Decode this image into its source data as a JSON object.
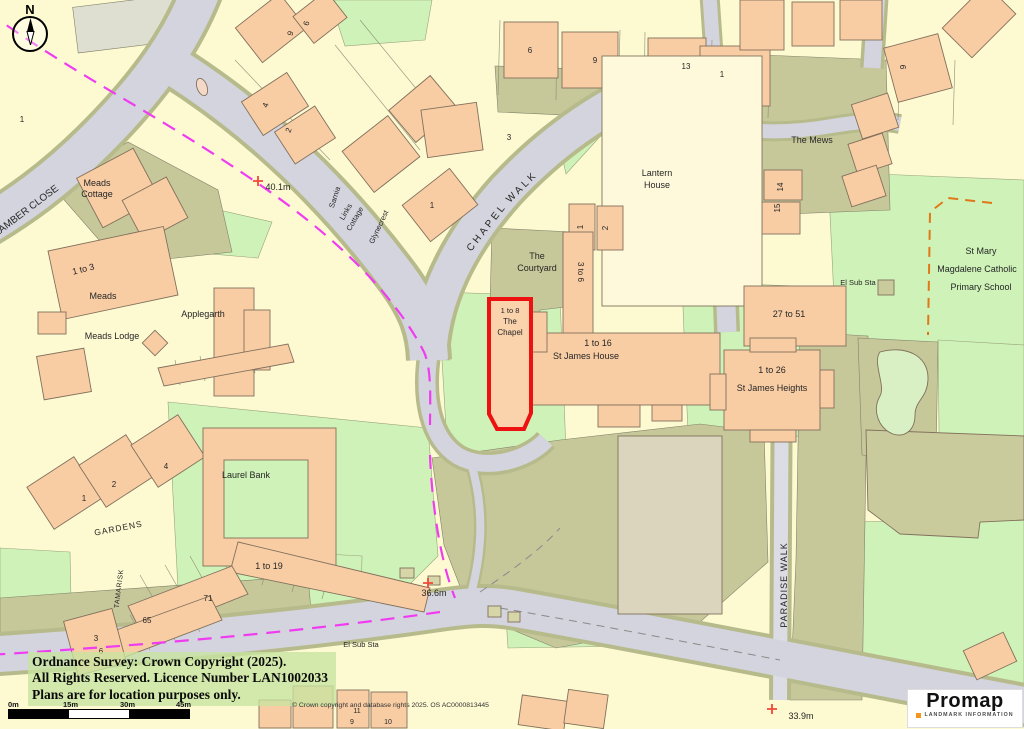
{
  "colors": {
    "parcel_yellow": "#FDFAD2",
    "building_peach": "#F8CDA4",
    "building_cream": "#FDF9DA",
    "road_gray": "#D4D4DE",
    "verge_olive": "#B7BB8B",
    "garden_olive": "#C6C89A",
    "grass_green": "#CEF2B8",
    "site_boundary_red": "#EE1111",
    "route_magenta": "#F03CF0",
    "route_orange": "#E07818",
    "spot_cross": "#F04838",
    "label_text": "#262626"
  },
  "north_indicator": {
    "letter": "N"
  },
  "labels": [
    {
      "t": "LAMBER CLOSE",
      "x": 28,
      "y": 213,
      "r": -37,
      "s": 10
    },
    {
      "t": "Meads",
      "x": 97,
      "y": 186,
      "s": 9
    },
    {
      "t": "Cottage",
      "x": 97,
      "y": 197,
      "s": 9
    },
    {
      "t": "1 to 3",
      "x": 84,
      "y": 272,
      "r": -14,
      "s": 9
    },
    {
      "t": "Meads",
      "x": 103,
      "y": 299,
      "s": 9
    },
    {
      "t": "Applegarth",
      "x": 203,
      "y": 317,
      "s": 9
    },
    {
      "t": "Meads Lodge",
      "x": 112,
      "y": 339,
      "s": 9
    },
    {
      "t": "40.1m",
      "x": 278,
      "y": 190,
      "s": 9
    },
    {
      "t": "Sarnia",
      "x": 337,
      "y": 198,
      "r": -72,
      "s": 7.5
    },
    {
      "t": "Links",
      "x": 348,
      "y": 213,
      "r": -60,
      "s": 7.5
    },
    {
      "t": "Cottage",
      "x": 357,
      "y": 220,
      "r": -60,
      "s": 7.5
    },
    {
      "t": "Glynecrest",
      "x": 381,
      "y": 228,
      "r": -65,
      "s": 7.5
    },
    {
      "t": "CHAPEL",
      "x": 489,
      "y": 229,
      "r": -52,
      "s": 10,
      "sp": 3
    },
    {
      "t": "WALK",
      "x": 524,
      "y": 189,
      "r": -45,
      "s": 10,
      "sp": 3
    },
    {
      "t": "The",
      "x": 537,
      "y": 259,
      "s": 9
    },
    {
      "t": "Courtyard",
      "x": 537,
      "y": 271,
      "s": 9
    },
    {
      "t": "1 to 8",
      "x": 510,
      "y": 313,
      "s": 7.5
    },
    {
      "t": "The",
      "x": 510,
      "y": 324,
      "s": 8
    },
    {
      "t": "Chapel",
      "x": 510,
      "y": 335,
      "s": 8
    },
    {
      "t": "Lantern",
      "x": 657,
      "y": 176,
      "s": 9
    },
    {
      "t": "House",
      "x": 657,
      "y": 188,
      "s": 9
    },
    {
      "t": "1",
      "x": 583,
      "y": 227,
      "r": -90,
      "s": 8
    },
    {
      "t": "2",
      "x": 608,
      "y": 228,
      "r": -90,
      "s": 8
    },
    {
      "t": "3 to 6",
      "x": 578,
      "y": 272,
      "r": 90,
      "s": 8
    },
    {
      "t": "1 to 16",
      "x": 598,
      "y": 346,
      "s": 9
    },
    {
      "t": "St James House",
      "x": 586,
      "y": 359,
      "s": 9
    },
    {
      "t": "The Mews",
      "x": 812,
      "y": 143,
      "s": 9
    },
    {
      "t": "14",
      "x": 783,
      "y": 187,
      "r": -90,
      "s": 8
    },
    {
      "t": "15",
      "x": 780,
      "y": 208,
      "r": -90,
      "s": 8
    },
    {
      "t": "El Sub Sta",
      "x": 858,
      "y": 285,
      "s": 7.5
    },
    {
      "t": "27 to 51",
      "x": 789,
      "y": 317,
      "s": 9
    },
    {
      "t": "1 to 26",
      "x": 772,
      "y": 373,
      "s": 9
    },
    {
      "t": "St James Heights",
      "x": 772,
      "y": 391,
      "s": 9
    },
    {
      "t": "St Mary",
      "x": 981,
      "y": 254,
      "s": 9
    },
    {
      "t": "Magdalene Catholic",
      "x": 977,
      "y": 272,
      "s": 9
    },
    {
      "t": "Primary School",
      "x": 981,
      "y": 290,
      "s": 9
    },
    {
      "t": "PARADISE WALK",
      "x": 787,
      "y": 585,
      "r": -90,
      "s": 9,
      "sp": 1
    },
    {
      "t": "36.6m",
      "x": 434,
      "y": 596,
      "s": 9
    },
    {
      "t": "El Sub Sta",
      "x": 361,
      "y": 647,
      "s": 7.5
    },
    {
      "t": "33.9m",
      "x": 801,
      "y": 719,
      "s": 9
    },
    {
      "t": "GARDENS",
      "x": 119,
      "y": 531,
      "r": -11,
      "s": 8.5,
      "sp": 1
    },
    {
      "t": "TAMARISK",
      "x": 121,
      "y": 589,
      "r": -83,
      "s": 7,
      "sp": 0.5
    },
    {
      "t": "Laurel Bank",
      "x": 246,
      "y": 478,
      "s": 9
    },
    {
      "t": "1 to 19",
      "x": 269,
      "y": 569,
      "s": 9
    },
    {
      "t": "71",
      "x": 208,
      "y": 601,
      "s": 8
    },
    {
      "t": "65",
      "x": 147,
      "y": 623,
      "s": 8
    },
    {
      "t": "3",
      "x": 96,
      "y": 641,
      "s": 8
    },
    {
      "t": "6",
      "x": 101,
      "y": 654,
      "s": 8
    },
    {
      "t": "1",
      "x": 84,
      "y": 501,
      "s": 8
    },
    {
      "t": "2",
      "x": 114,
      "y": 487,
      "s": 8
    },
    {
      "t": "4",
      "x": 166,
      "y": 469,
      "s": 8
    },
    {
      "t": "6",
      "x": 530,
      "y": 53,
      "s": 8
    },
    {
      "t": "9",
      "x": 595,
      "y": 63,
      "s": 8
    },
    {
      "t": "13",
      "x": 686,
      "y": 69,
      "s": 8
    },
    {
      "t": "1",
      "x": 722,
      "y": 77,
      "s": 8
    },
    {
      "t": "3",
      "x": 509,
      "y": 140,
      "s": 8
    },
    {
      "t": "9",
      "x": 293,
      "y": 34,
      "r": -75,
      "s": 8
    },
    {
      "t": "6",
      "x": 309,
      "y": 24,
      "r": -75,
      "s": 8
    },
    {
      "t": "4",
      "x": 268,
      "y": 106,
      "r": -70,
      "s": 8
    },
    {
      "t": "2",
      "x": 291,
      "y": 131,
      "r": -70,
      "s": 8
    },
    {
      "t": "9",
      "x": 906,
      "y": 67,
      "r": -90,
      "s": 8
    },
    {
      "t": "1",
      "x": 432,
      "y": 208,
      "s": 8
    },
    {
      "t": "1",
      "x": 22,
      "y": 122,
      "s": 8
    },
    {
      "t": "11",
      "x": 357,
      "y": 713,
      "s": 7
    },
    {
      "t": "9",
      "x": 352,
      "y": 724,
      "s": 7
    },
    {
      "t": "10",
      "x": 388,
      "y": 724,
      "s": 7
    }
  ],
  "spot_crosses": [
    {
      "x": 258,
      "y": 181
    },
    {
      "x": 428,
      "y": 583
    },
    {
      "x": 772,
      "y": 709
    }
  ],
  "attribution": {
    "line1": "Ordnance Survey: Crown Copyright (2025).",
    "line2": "All Rights Reserved. Licence Number LAN1002033",
    "line3": "Plans are for location purposes only."
  },
  "scale_bar": {
    "ticks": [
      "0m",
      "15m",
      "30m",
      "45m"
    ]
  },
  "os_credit": "© Crown copyright and database rights 2025. OS AC0000813445",
  "logo": {
    "brand": "Promap",
    "tagline": "LANDMARK INFORMATION",
    "dot_color": "#F7941D"
  }
}
